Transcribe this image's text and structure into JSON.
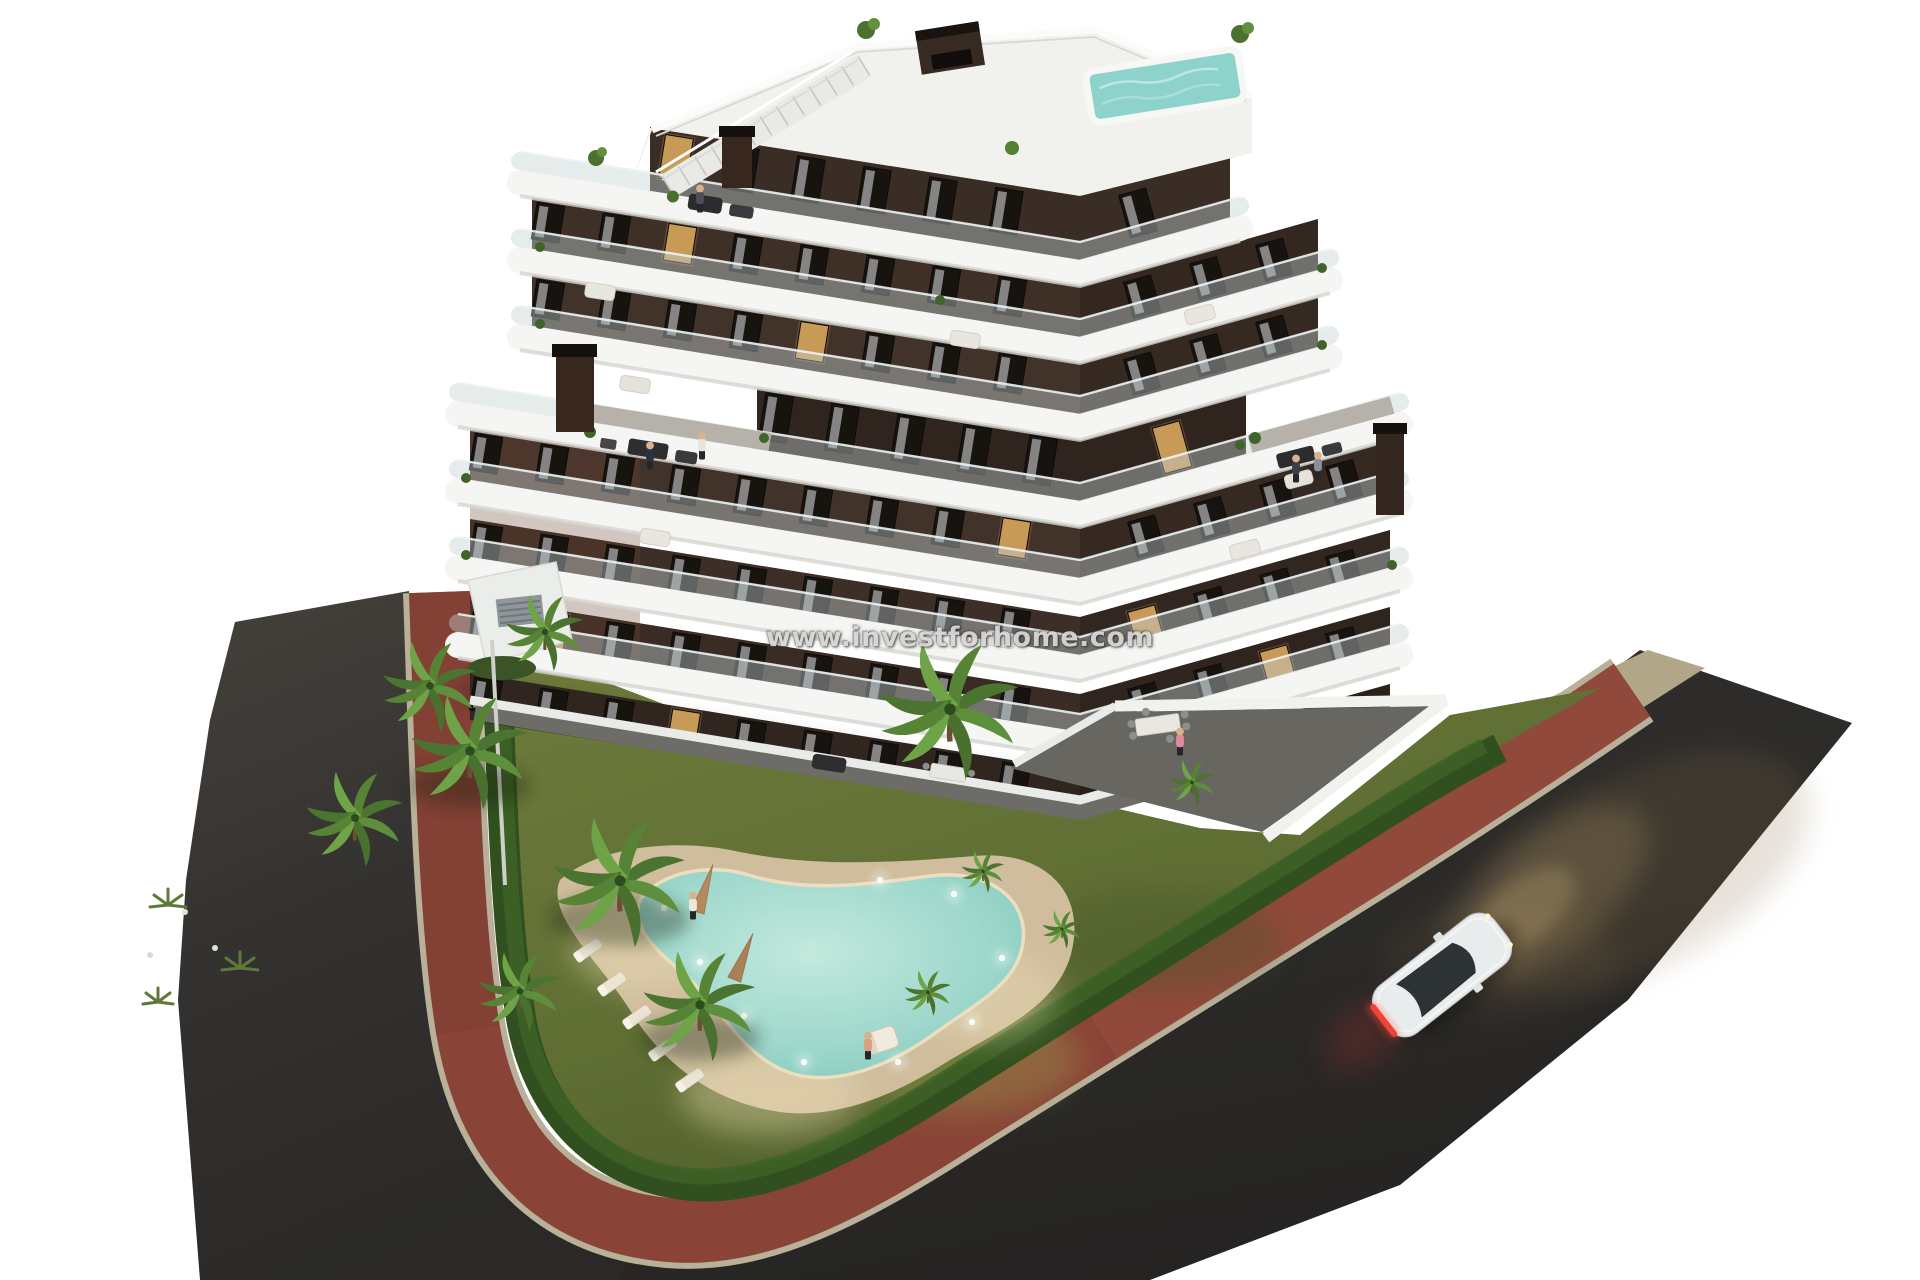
{
  "watermark": {
    "text": "www.investforhome.com"
  },
  "scene": {
    "description": "Aerial dusk 3D architectural render of a modern stepped apartment building with curved white balconies, landscaped garden, free-form lit swimming pool, palm trees, red brick sidewalk, asphalt roads and a white car with headlights on",
    "colors": {
      "background": "#ffffff",
      "asphalt_road": "#2e2c2a",
      "brick_sidewalk": "#8a4437",
      "curb": "#b9b09a",
      "lawn": "#69773a",
      "hedge": "#32501f",
      "pool_water": "#9fd8cc",
      "pool_deck": "#cfbd9d",
      "building_wall": "#3e3027",
      "balcony_band": "#f5f5f3",
      "rooftop_pool": "#8ed2cc",
      "lit_window": "#c79a58",
      "car_body": "#e9ecec",
      "car_taillight": "#e23b2e",
      "headlight_glow": "#d9b878"
    }
  }
}
